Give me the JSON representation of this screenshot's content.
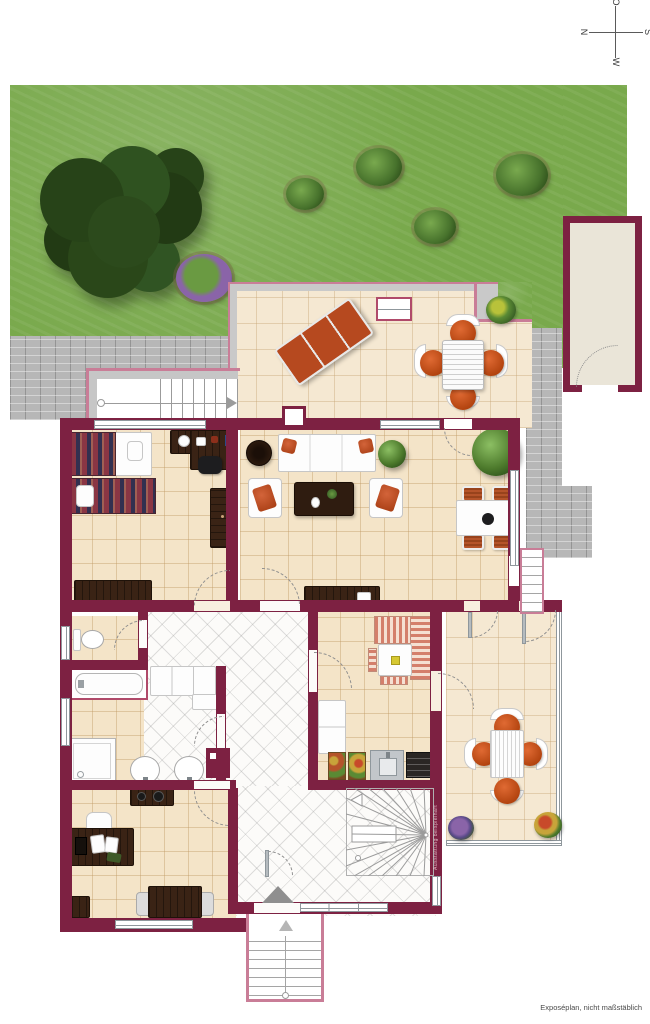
{
  "page": {
    "width": 650,
    "height": 1024,
    "background": "#ffffff",
    "disclaimer": "Exposéplan, nicht maßstäblich",
    "watermark": "Ausstattung beispielhaft"
  },
  "compass": {
    "top": "O",
    "right": "S",
    "bottom": "W",
    "left": "N"
  },
  "palette": {
    "wall": "#7d2142",
    "floor-tile": "#f4e4c8",
    "tile-line": "#d9bf94",
    "hall-tile": "#fcfbf9",
    "grass": "#79a94c",
    "paving": "#b7b7b7",
    "outline-pink": "#c97d97",
    "glass": "#8f979c",
    "wood": "#3a2315",
    "orange": "#c2511f",
    "garage-floor": "#eae5d8"
  },
  "rooms": [
    {
      "id": "garden",
      "label": "garden",
      "items": [
        "large-tree",
        "bushes",
        "flower-bed",
        "lawn"
      ]
    },
    {
      "id": "terrace",
      "label": "terrace",
      "items": [
        "sun-lounger",
        "outdoor-dining-set",
        "plant-pot",
        "skylight",
        "chimney",
        "garden-stairs"
      ]
    },
    {
      "id": "garage",
      "label": "garage",
      "items": [
        "garage-door"
      ]
    },
    {
      "id": "living-dining",
      "label": "living-dining-room",
      "items": [
        "sofa",
        "armchair",
        "armchair",
        "coffee-table",
        "round-side-table",
        "dining-table",
        "dining-chairs",
        "sideboard",
        "plants"
      ]
    },
    {
      "id": "bedroom",
      "label": "bedroom",
      "items": [
        "bed",
        "bed",
        "nightstand",
        "desk",
        "desk-chair",
        "wardrobe",
        "sideboard"
      ]
    },
    {
      "id": "kitchen",
      "label": "kitchen",
      "items": [
        "corner-counter",
        "island-table",
        "stools",
        "cabinets",
        "sink",
        "stove",
        "storage-crates"
      ]
    },
    {
      "id": "wc",
      "label": "wc",
      "items": [
        "toilet"
      ]
    },
    {
      "id": "bathroom",
      "label": "bathroom",
      "items": [
        "bathtub",
        "shower",
        "washbasin",
        "washbasin",
        "utility-box"
      ]
    },
    {
      "id": "office",
      "label": "office",
      "items": [
        "desk",
        "office-chair",
        "sideboard",
        "side-table",
        "meeting-table",
        "chairs"
      ]
    },
    {
      "id": "hallway",
      "label": "hallway",
      "items": [
        "built-in-closet",
        "winding-staircase",
        "entrance-door",
        "entrance-steps",
        "side-steps"
      ]
    },
    {
      "id": "conservatory",
      "label": "conservatory",
      "items": [
        "table",
        "orange-chairs",
        "flower-pot",
        "flower-pot",
        "glass-walls"
      ]
    }
  ]
}
